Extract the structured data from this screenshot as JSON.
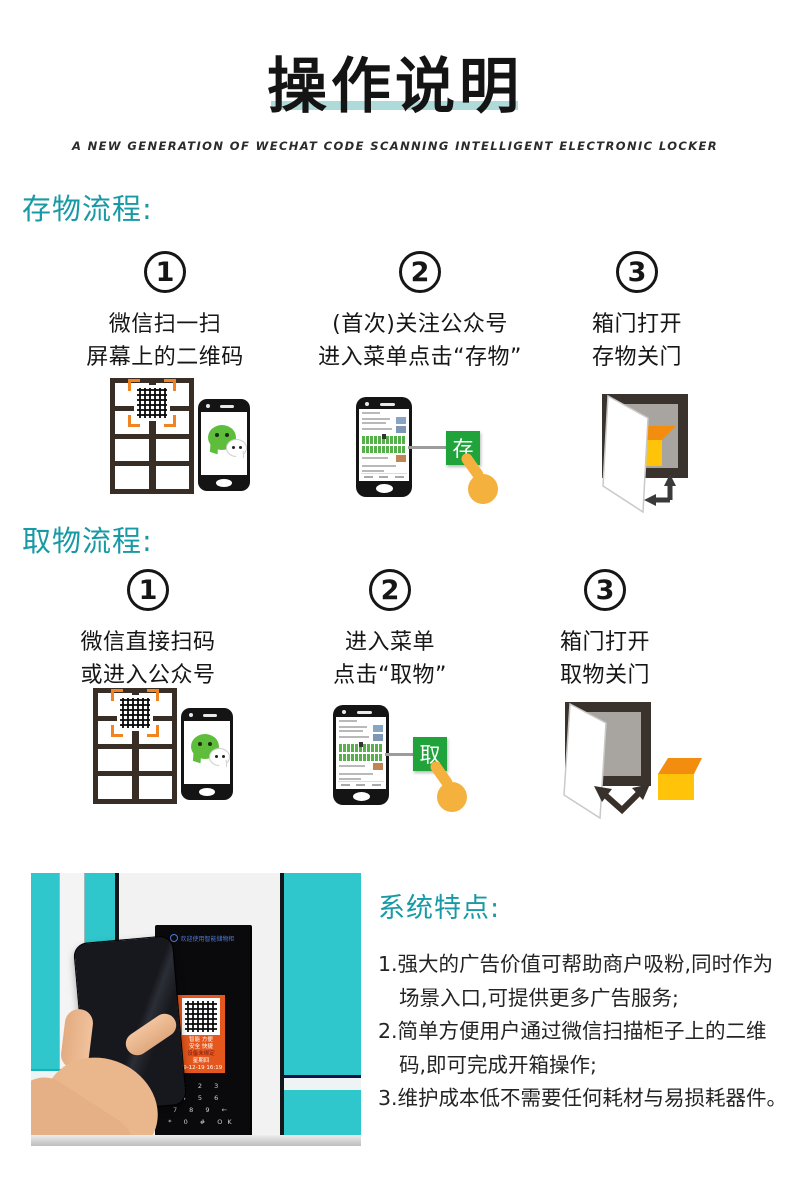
{
  "header": {
    "title": "操作说明",
    "subtitle": "A NEW GENERATION OF WECHAT CODE SCANNING INTELLIGENT ELECTRONIC LOCKER"
  },
  "deposit": {
    "heading": "存物流程:",
    "steps": [
      {
        "num": "1",
        "line1": "微信扫一扫",
        "line2": "屏幕上的二维码"
      },
      {
        "num": "2",
        "line1": "(首次)关注公众号",
        "line2": "进入菜单点击“存物”"
      },
      {
        "num": "3",
        "line1": "箱门打开",
        "line2": "存物关门"
      }
    ],
    "action_button": "存"
  },
  "retrieve": {
    "heading": "取物流程:",
    "steps": [
      {
        "num": "1",
        "line1": "微信直接扫码",
        "line2": "或进入公众号"
      },
      {
        "num": "2",
        "line1": "进入菜单",
        "line2": "点击“取物”"
      },
      {
        "num": "3",
        "line1": "箱门打开",
        "line2": "取物关门"
      }
    ],
    "action_button": "取"
  },
  "features": {
    "heading": "系统特点:",
    "items": [
      {
        "line1": "1.强大的广告价值可帮助商户吸粉,同时作为",
        "line2": "场景入口,可提供更多广告服务;"
      },
      {
        "line1": "2.简单方便用户通过微信扫描柜子上的二维",
        "line2": "码,即可完成开箱操作;"
      },
      {
        "line1": "3.维护成本低不需要任何耗材与易损耗器件。",
        "line2": ""
      }
    ]
  },
  "photo": {
    "panel_title": "欢迎使用智能储物柜",
    "screen_lines": [
      "智能 方便",
      "安全 快捷",
      "设备未绑定",
      "星期四",
      "19-12-19 16:19"
    ],
    "keypad_rows": [
      "1 2 3",
      "4 5 6",
      "7 8 9 ←",
      "* 0 # OK"
    ]
  },
  "colors": {
    "accent_teal": "#189aa6",
    "underline_teal": "#aedada",
    "wechat_green": "#5ebe3c",
    "button_green": "#1fa33a",
    "hand_yellow": "#f4b13e",
    "box_yellow": "#ffc40a",
    "box_orange": "#f28d10",
    "photo_teal": "#2fc7cc",
    "card_orange": "#e5571c"
  }
}
